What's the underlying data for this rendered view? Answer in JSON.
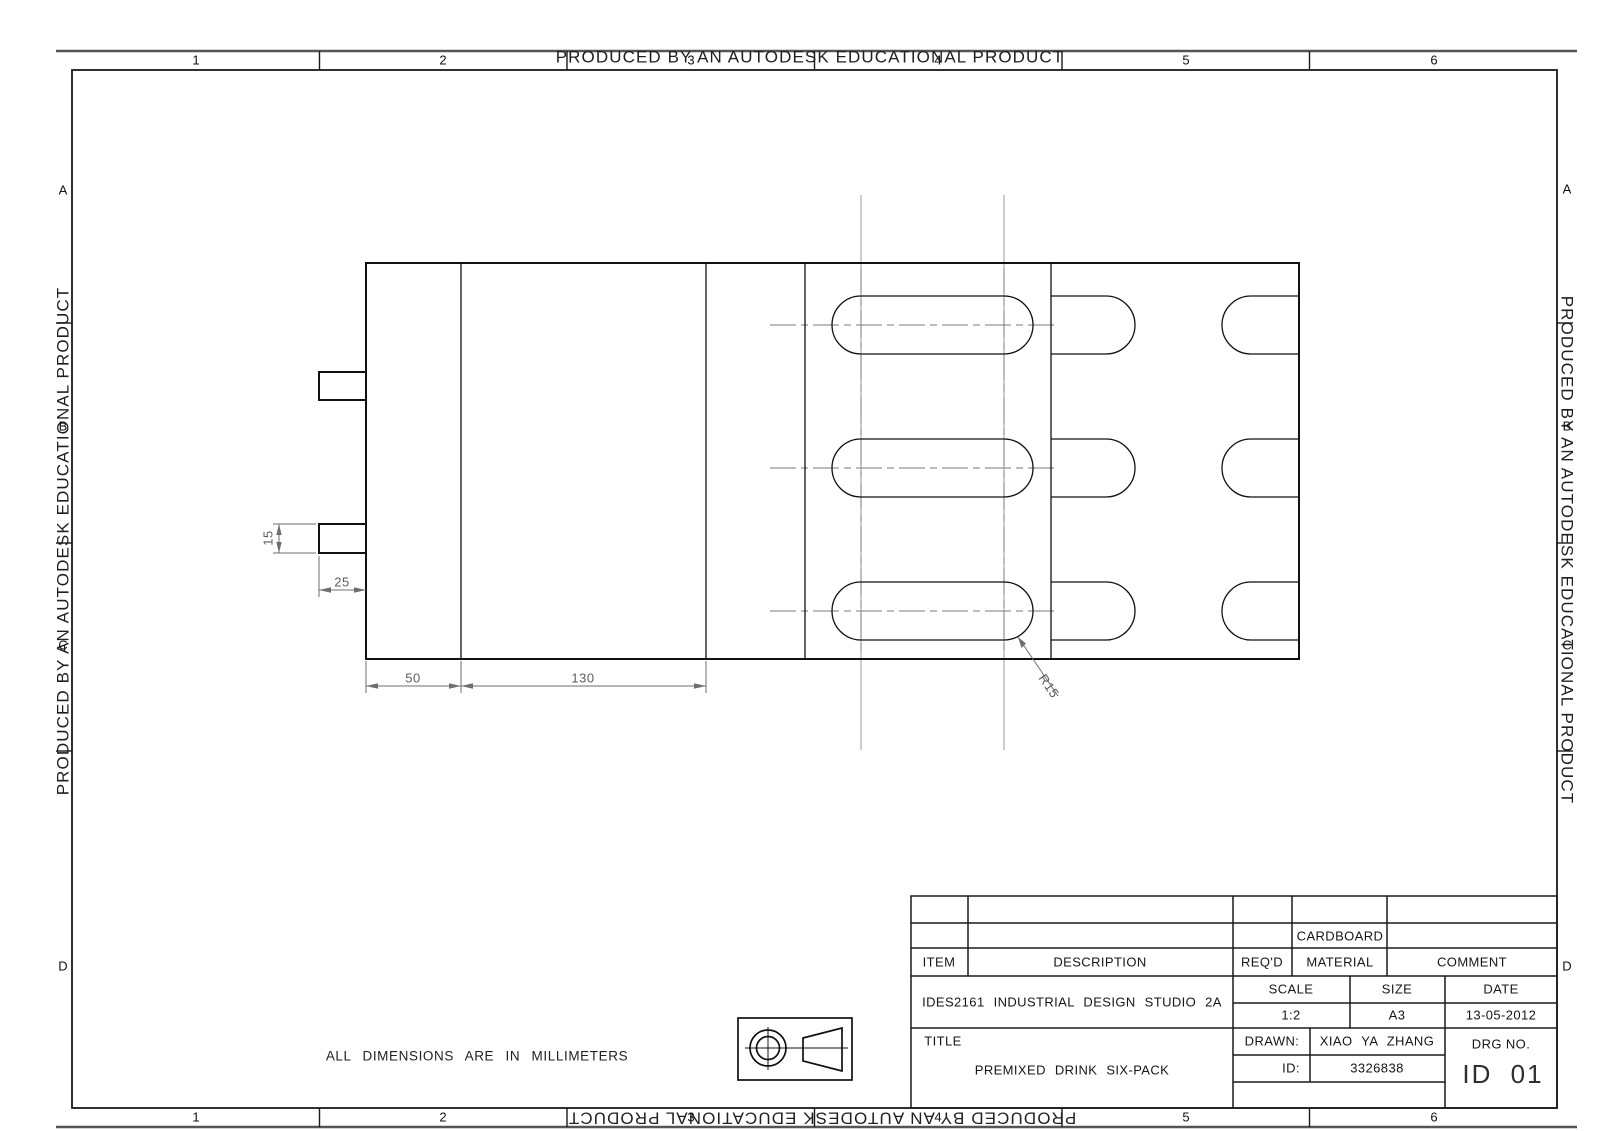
{
  "watermark": {
    "text": "PRODUCED BY AN AUTODESK EDUCATIONAL PRODUCT"
  },
  "zones": {
    "columns": [
      "1",
      "2",
      "3",
      "4",
      "5",
      "6"
    ],
    "rows": [
      "A",
      "B",
      "C",
      "D"
    ]
  },
  "drawing": {
    "dimensions": {
      "tab_height": "15",
      "tab_width": "25",
      "left_flap_width": "50",
      "panel_width": "130",
      "slot_radius": "R15"
    },
    "note": "ALL DIMENSIONS ARE IN MILLIMETERS"
  },
  "title_block": {
    "item_label": "ITEM",
    "description_label": "DESCRIPTION",
    "reqd_label": "REQ'D",
    "material_label": "MATERIAL",
    "comment_label": "COMMENT",
    "material_value": "CARDBOARD",
    "course": "IDES2161 INDUSTRIAL DESIGN STUDIO 2A",
    "scale_label": "SCALE",
    "scale_value": "1:2",
    "size_label": "SIZE",
    "size_value": "A3",
    "date_label": "DATE",
    "date_value": "13-05-2012",
    "title_label": "TITLE",
    "title_value": "PREMIXED DRINK SIX-PACK",
    "drawn_label": "DRAWN:",
    "drawn_value": "XIAO YA ZHANG",
    "id_label": "ID:",
    "id_value": "3326838",
    "drg_label": "DRG NO.",
    "drg_value": "ID 01"
  }
}
